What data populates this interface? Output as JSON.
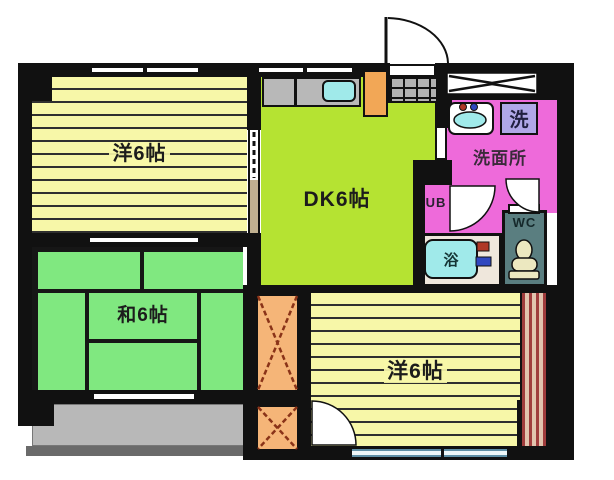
{
  "plan_title": "apartment-floor-plan",
  "rooms": {
    "west_room_top": {
      "label": "洋6帖",
      "color": "#f7f7a8"
    },
    "dining_kitchen": {
      "label": "DK6帖",
      "color": "#b5e332"
    },
    "japanese_room": {
      "label": "和6帖",
      "color": "#80e880"
    },
    "west_room_bottom": {
      "label": "洋6帖",
      "color": "#f7f7a8"
    },
    "washroom": {
      "label": "洗面所",
      "color": "#ee6ada"
    },
    "unit_bath": {
      "label": "UB",
      "color": "#ee6ada"
    },
    "toilet": {
      "label": "WC",
      "color": "#5a7e80"
    }
  },
  "fixtures": {
    "bathtub": {
      "label": "浴",
      "color": "#a0eaea"
    },
    "washing_machine": {
      "label": "洗",
      "color": "#b0a8e8"
    },
    "sink_color": "#a0eaea",
    "bath_floor_color": "#efe7dc"
  },
  "colors": {
    "wall": "#111111",
    "flooring_stripe": "#2f2f2f",
    "closet": "#f5b578",
    "closet_x": "#8a3318",
    "fridge_space": "#f2a756",
    "balcony": "#b8b8b8",
    "balcony_rail": "#6a6a6a",
    "kitchen_counter": "#b8b8b8",
    "storage_stripes": "#a03c3c",
    "hot_tap": "#b03826",
    "cold_tap": "#3048c0"
  }
}
